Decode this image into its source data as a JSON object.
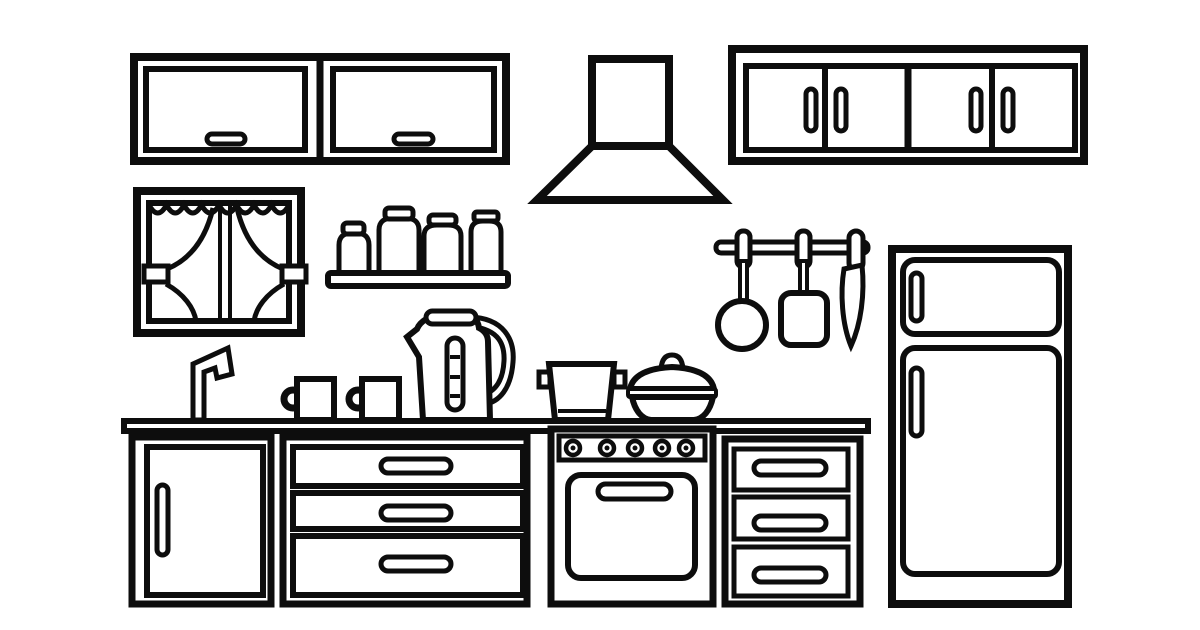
{
  "scene": {
    "description": "Black-and-white line-art illustration of a kitchen interior (coloring-book style): wall cabinets, extractor hood, window with curtains, shelf with jars, hanging utensils, refrigerator, counter with faucet, mugs, kettle, pot and casserole, base cabinet, drawer units and a stove with oven",
    "style": {
      "line_color": "#0d0d0d",
      "background_color": "#ffffff",
      "fill_color": "#ffffff"
    },
    "objects": [
      {
        "id": "wall-cabinet-left",
        "label": "Two-door wall cabinet with horizontal handles",
        "doors": 2
      },
      {
        "id": "range-hood",
        "label": "Extractor hood with duct"
      },
      {
        "id": "wall-cabinet-right",
        "label": "Four-door wall cabinet with vertical handles",
        "doors": 4
      },
      {
        "id": "window",
        "label": "Window with scalloped valance and tied-back curtains"
      },
      {
        "id": "jar-shelf",
        "label": "Wall shelf with four lidded jars",
        "jars": 4
      },
      {
        "id": "utensil-rail",
        "label": "Hanging rail with ladle, spatula and knife",
        "utensils": 3
      },
      {
        "id": "refrigerator",
        "label": "Two-door refrigerator with freezer on top"
      },
      {
        "id": "countertop",
        "label": "Kitchen counter"
      },
      {
        "id": "faucet",
        "label": "Sink faucet"
      },
      {
        "id": "mugs",
        "label": "Two mugs",
        "count": 2
      },
      {
        "id": "kettle",
        "label": "Electric kettle with water gauge"
      },
      {
        "id": "pot",
        "label": "Stock pot with side handles"
      },
      {
        "id": "casserole",
        "label": "Casserole dish with domed lid"
      },
      {
        "id": "base-cabinet",
        "label": "Base cabinet with single door"
      },
      {
        "id": "drawer-unit-left",
        "label": "Drawer unit with three drawers",
        "drawers": 3
      },
      {
        "id": "stove",
        "label": "Stove with five knobs and oven door",
        "knobs": 5
      },
      {
        "id": "drawer-unit-right",
        "label": "Drawer unit with three drawers",
        "drawers": 3
      }
    ]
  }
}
